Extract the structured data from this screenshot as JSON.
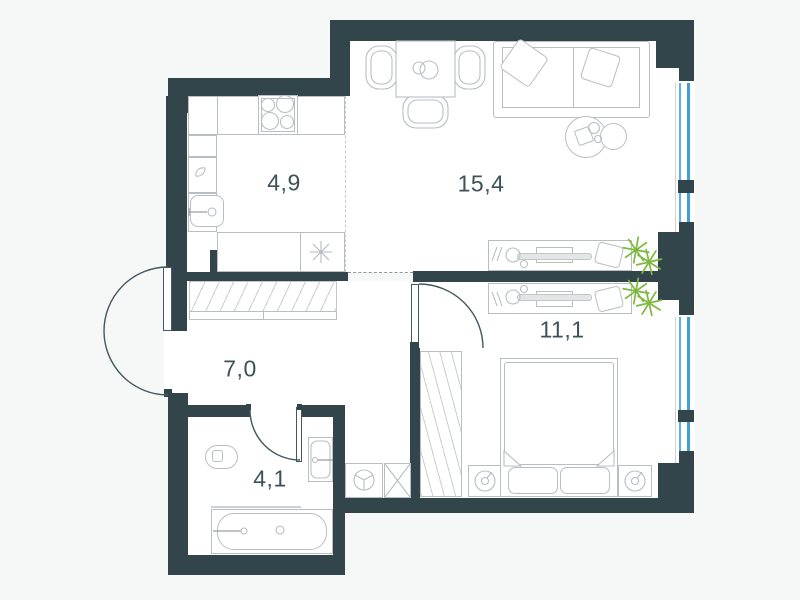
{
  "title": "one-bedroom apartment floor plan",
  "rooms": {
    "kitchen": {
      "label": "4,9"
    },
    "living": {
      "label": "15,4"
    },
    "bedroom": {
      "label": "11,1"
    },
    "hallway": {
      "label": "7,0"
    },
    "bathroom": {
      "label": "4,1"
    }
  },
  "colors": {
    "wall": "#31454b",
    "floor": "#ffffff",
    "background": "#f6f7f7",
    "window_glass": "#5ab3e6",
    "window_frame": "#3f9fd8",
    "furniture_line": "#b9bec3",
    "door_line": "#44585e",
    "plant": "#7cb93e",
    "label_text": "#3d5159"
  },
  "icons": {
    "stove": "four-burner-cooktop",
    "kitchen_sink": "rounded-basin-with-faucet",
    "fridge": "asterisk-star",
    "dining_set": "square-table-three-chairs-two-plates",
    "sofa": "two-seat-sofa-two-pillows",
    "coffee_table": "two-overlapping-circles",
    "desk": "worktable-with-monitor-cup-pens-chair",
    "plant": "leaf-burst",
    "wardrobe": "hatched-cabinet",
    "closet": "diagonal-hatched-storage",
    "bed": "double-bed-blanket-two-pillows",
    "nightstand": "square-with-lamp-circle",
    "toilet": "rounded-bowl",
    "bath_sink": "wall-basin-with-faucet",
    "bathtub": "rounded-tub-with-drain",
    "washing_machine": "square-with-spoked-drum",
    "shaft": "crossed-box",
    "door": "quarter-or-half-swing-arc",
    "window": "double-blue-line-glazing"
  }
}
